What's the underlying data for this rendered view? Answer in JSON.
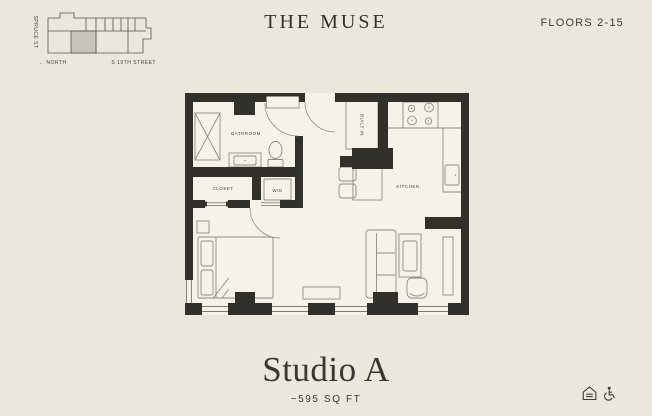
{
  "header": {
    "title": "THE MUSE",
    "floors_label": "FLOORS 2-15"
  },
  "site_map": {
    "street_left": "SPRUCE ST",
    "north_label": "← NORTH",
    "street_bottom": "S 19TH STREET"
  },
  "floor_plan": {
    "labels": {
      "bathroom": "BATHROOM",
      "closet": "CLOSET",
      "washer_dryer": "W/D",
      "built_in": "BUILT IN",
      "kitchen": "KITCHEN"
    }
  },
  "footer": {
    "unit_name": "Studio A",
    "area": "~595 SQ FT"
  },
  "colors": {
    "background": "#ece7dd",
    "plan_fill": "#f6f2e9",
    "wall": "#31302b",
    "furniture_line": "#8f8b80",
    "text": "#36342f",
    "unit_highlight": "#c7c3b8"
  }
}
